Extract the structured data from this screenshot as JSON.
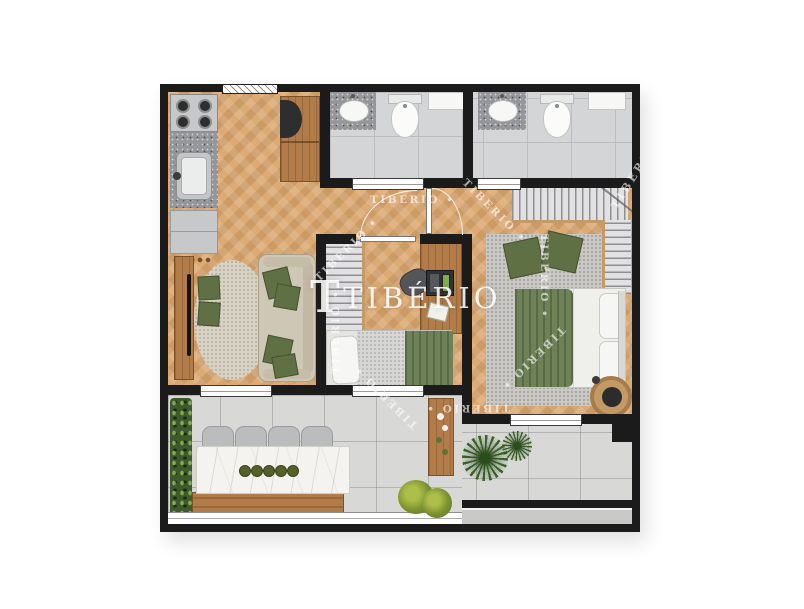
{
  "watermark": {
    "brand_mark": "T",
    "brand": "TIBÉRIO",
    "ring_item": "TIBERIO •",
    "diag_item": "TIBERIO •"
  },
  "palette": {
    "wall": "#1b1b1b",
    "wood_floor": "#dcaa73",
    "bathroom_tile": "#d4d5d7",
    "balcony_tile": "#d8d9d7",
    "accent_green": "#6f8257",
    "furniture_wood": "#b27c4a",
    "marble": "#f4f3f0",
    "rug_gray": "#cbc9c5",
    "rug_beige": "#d8d2c4",
    "garden_green": "#3e5a2c",
    "watermark": "#ffffff"
  }
}
